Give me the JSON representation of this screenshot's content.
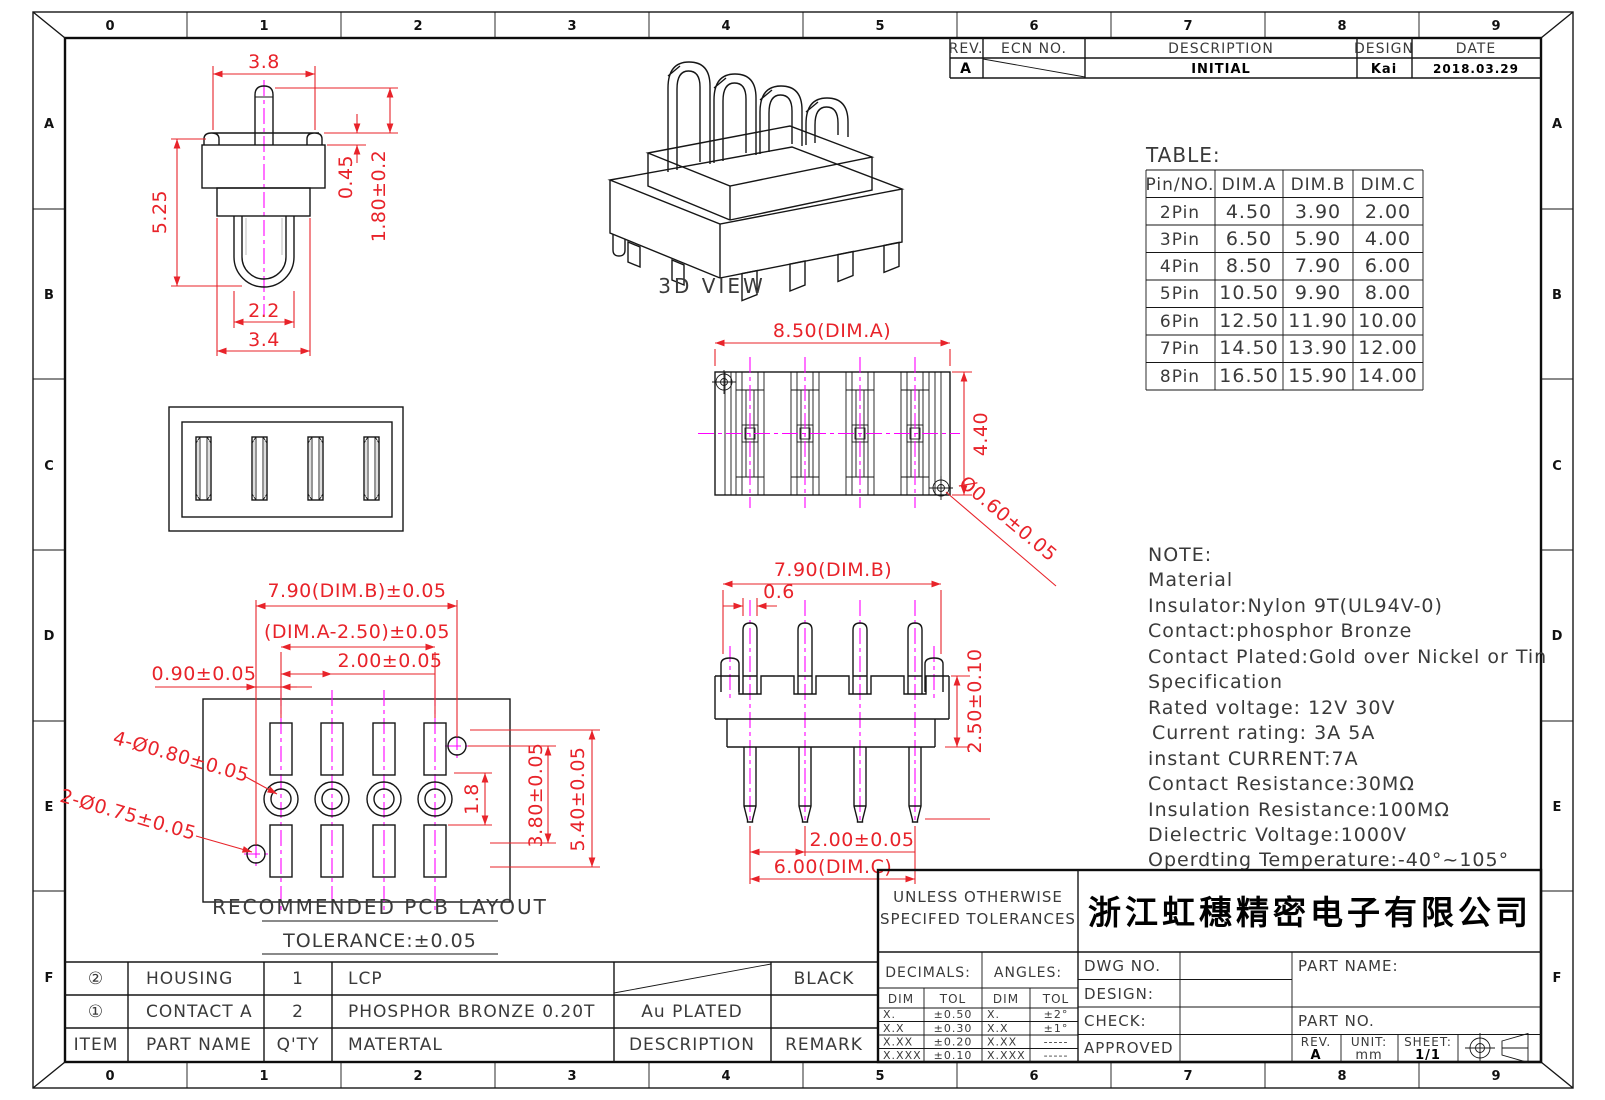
{
  "sheet": {
    "zones_h": [
      "0",
      "1",
      "2",
      "3",
      "4",
      "5",
      "6",
      "7",
      "8",
      "9"
    ],
    "zones_v": [
      "A",
      "B",
      "C",
      "D",
      "E",
      "F"
    ]
  },
  "revision_table": {
    "col_rev": "REV.",
    "col_ecn": "ECN NO.",
    "col_desc": "DESCRIPTION",
    "col_design": "DESIGN",
    "col_date": "DATE",
    "rev": "A",
    "description": "INITIAL",
    "design": "Kai",
    "date": "2018.03.29"
  },
  "dim_table": {
    "title": "TABLE:",
    "headers": [
      "Pin/NO.",
      "DIM.A",
      "DIM.B",
      "DIM.C"
    ],
    "rows": [
      [
        "2Pin",
        "4.50",
        "3.90",
        "2.00"
      ],
      [
        "3Pin",
        "6.50",
        "5.90",
        "4.00"
      ],
      [
        "4Pin",
        "8.50",
        "7.90",
        "6.00"
      ],
      [
        "5Pin",
        "10.50",
        "9.90",
        "8.00"
      ],
      [
        "6Pin",
        "12.50",
        "11.90",
        "10.00"
      ],
      [
        "7Pin",
        "14.50",
        "13.90",
        "12.00"
      ],
      [
        "8Pin",
        "16.50",
        "15.90",
        "14.00"
      ]
    ]
  },
  "notes": {
    "lines": [
      "NOTE:",
      "Material",
      "Insulator:Nylon 9T(UL94V-0)",
      "Contact:phosphor Bronze",
      "Contact Plated:Gold over Nickel or Tin",
      "Specification",
      "Rated voltage: 12V 30V",
      "Current rating: 3A  5A",
      "instant CURRENT:7A",
      "Contact Resistance:30MΩ",
      "Insulation Resistance:100MΩ",
      "Dielectric Voltage:1000V",
      "Operdting Temperature:-40°~105°"
    ]
  },
  "views": {
    "view3d_label": "3D VIEW",
    "side": {
      "w_top": "3.8",
      "h_left": "5.25",
      "d1": "0.45",
      "d2": "1.80±0.2",
      "w_u": "2.2",
      "w_body": "3.4"
    },
    "top": {
      "dim_a": "8.50(DIM.A)",
      "h": "4.40",
      "hole": "Ø0.60±0.05"
    },
    "front": {
      "dim_b": "7.90(DIM.B)",
      "pin_w": "0.6",
      "h": "2.50±0.10",
      "pitch": "2.00±0.05",
      "dim_c": "6.00(DIM.C)"
    },
    "pcb": {
      "dim_b": "7.90(DIM.B)±0.05",
      "dim_a": "(DIM.A-2.50)±0.05",
      "pitch": "2.00±0.05",
      "offset": "0.90±0.05",
      "holes_a": "4-Ø0.80±0.05",
      "holes_b": "2-Ø0.75±0.05",
      "d18": "1.8",
      "d380": "3.80±0.05",
      "d540": "5.40±0.05",
      "title": "RECOMMENDED PCB LAYOUT",
      "tolerance": "TOLERANCE:±0.05"
    }
  },
  "bom": {
    "headers": {
      "item": "ITEM",
      "part_name": "PART NAME",
      "qty": "Q'TY",
      "material": "MATERTAL",
      "description": "DESCRIPTION",
      "remark": "REMARK"
    },
    "rows": [
      {
        "item": "②",
        "part_name": "HOUSING",
        "qty": "1",
        "material": "LCP",
        "description": "",
        "remark": "BLACK"
      },
      {
        "item": "①",
        "part_name": "CONTACT A",
        "qty": "2",
        "material": "PHOSPHOR BRONZE 0.20T",
        "description": "Au PLATED",
        "remark": ""
      }
    ]
  },
  "title_block": {
    "tol_line1": "UNLESS OTHERWISE",
    "tol_line2": "SPECIFED TOLERANCES",
    "company": "浙江虹穗精密电子有限公司",
    "decimals": "DECIMALS:",
    "angles": "ANGLES:",
    "dim": "DIM",
    "tol": "TOL",
    "dec_rows": [
      [
        "X.",
        "±0.50"
      ],
      [
        "X.X",
        "±0.30"
      ],
      [
        "X.XX",
        "±0.20"
      ],
      [
        "X.XXX",
        "±0.10"
      ]
    ],
    "ang_rows": [
      [
        "X.",
        "±2°"
      ],
      [
        "X.X",
        "±1°"
      ],
      [
        "X.XX",
        "-----"
      ],
      [
        "X.XXX",
        "-----"
      ]
    ],
    "dwg_no": "DWG NO.",
    "design": "DESIGN:",
    "check": "CHECK:",
    "approved": "APPROVED",
    "part_name": "PART NAME:",
    "part_no": "PART NO.",
    "rev_label": "REV.",
    "rev": "A",
    "unit_label": "UNIT:",
    "unit": "mm",
    "sheet_label": "SHEET:",
    "sheet": "1/1"
  }
}
